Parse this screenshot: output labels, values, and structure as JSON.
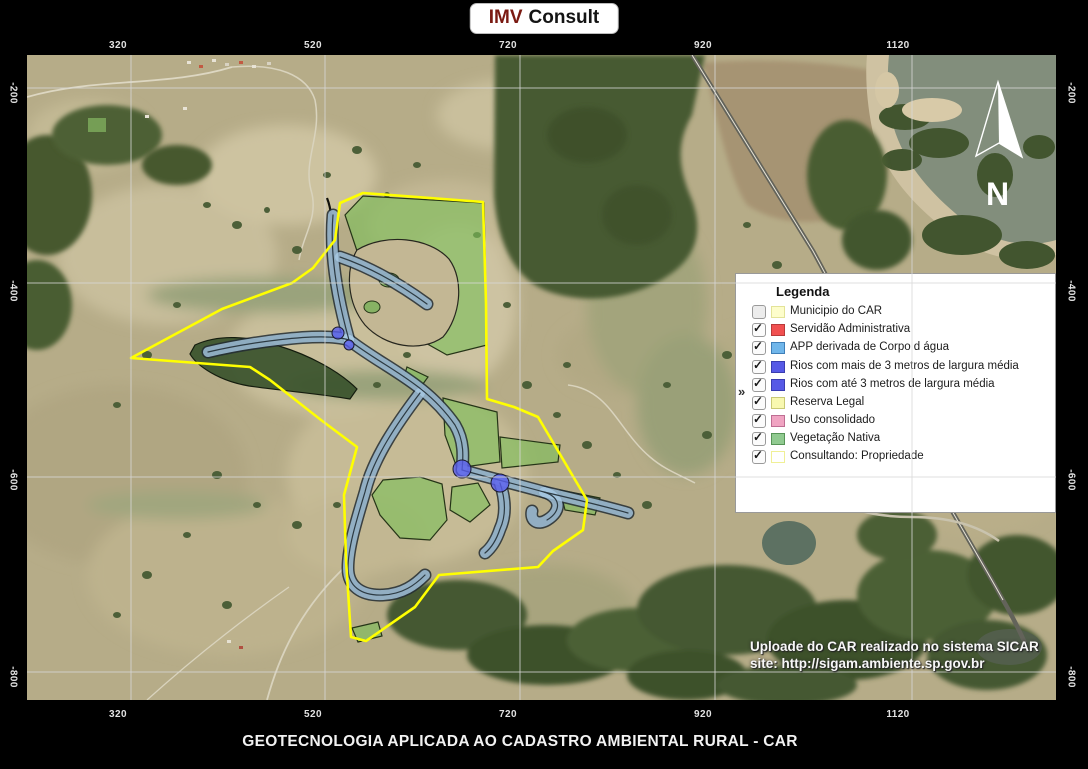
{
  "header": {
    "brand_primary": "IMV",
    "brand_secondary": "Consult"
  },
  "axes": {
    "top": [
      "320",
      "520",
      "720",
      "920",
      "1120"
    ],
    "bottom": [
      "320",
      "520",
      "720",
      "920",
      "1120"
    ],
    "left": [
      "-200",
      "-400",
      "-600",
      "-800"
    ],
    "right": [
      "-200",
      "-400",
      "-600",
      "-800"
    ]
  },
  "north_label": "N",
  "icons": {
    "check": "✓",
    "collapse": "»",
    "north-arrow": "compass-needle"
  },
  "legend": {
    "title": "Legenda",
    "items": [
      {
        "label": "Municipio do CAR",
        "checked": false,
        "fill": "#FDFDCB",
        "border": "#E3E398"
      },
      {
        "label": "Servidão Administrativa",
        "checked": true,
        "fill": "#F15050",
        "border": "#B83A3A"
      },
      {
        "label": "APP derivada de Corpo d água",
        "checked": true,
        "fill": "#70B6EA",
        "border": "#3F7FB8"
      },
      {
        "label": "Rios com mais de 3 metros de largura média",
        "checked": true,
        "fill": "#5659E6",
        "border": "#3A3DB0"
      },
      {
        "label": "Rios com até 3 metros de largura média",
        "checked": true,
        "fill": "#5659E6",
        "border": "#3A3DB0"
      },
      {
        "label": "Reserva Legal",
        "checked": true,
        "fill": "#F8F8B0",
        "border": "#C9C975"
      },
      {
        "label": "Uso consolidado",
        "checked": true,
        "fill": "#F0A4C2",
        "border": "#BE6E93"
      },
      {
        "label": "Vegetação Nativa",
        "checked": true,
        "fill": "#90CA90",
        "border": "#579457"
      },
      {
        "label": "Consultando: Propriedade",
        "checked": true,
        "fill": "#FFFFFF",
        "border": "#F0F096"
      }
    ]
  },
  "map_note": {
    "line1": "Uploade do CAR realizado no sistema SICAR",
    "line2": "site: http://sigam.ambiente.sp.gov.br"
  },
  "footer": {
    "title": "GEOTECNOLOGIA APLICADA AO CADASTRO AMBIENTAL RURAL - CAR"
  },
  "colors": {
    "property_boundary": "#FFFF00",
    "app_buffer": "#A9CBE3",
    "rios_junction": "#585CEB",
    "vegetation_overlay": "#7DBE58",
    "grid": "#D7D7D7"
  }
}
